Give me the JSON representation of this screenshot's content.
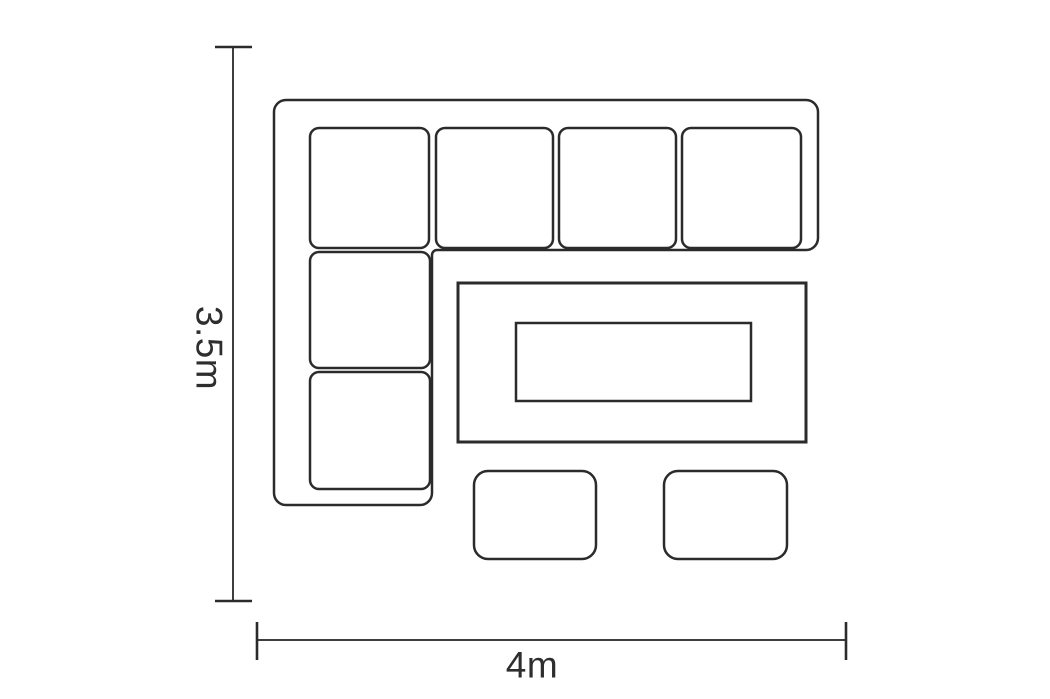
{
  "diagram": {
    "name": "corner-sofa-set-floor-plan",
    "height_dimension": {
      "label": "3.5m"
    },
    "width_dimension": {
      "label": "4m"
    },
    "colors": {
      "line": "#2b2b2b",
      "dimension_line": "#3e3e3e",
      "text": "#2e2e2e",
      "background": "#ffffff"
    },
    "elements": {
      "corner_sofa": {
        "shape": "L",
        "seat_cushions": 6,
        "top_row_cushions": 4,
        "left_column_extra_cushions": 2
      },
      "coffee_table": {
        "count": 1,
        "has_inner_panel": true
      },
      "stools": {
        "count": 2
      }
    }
  }
}
